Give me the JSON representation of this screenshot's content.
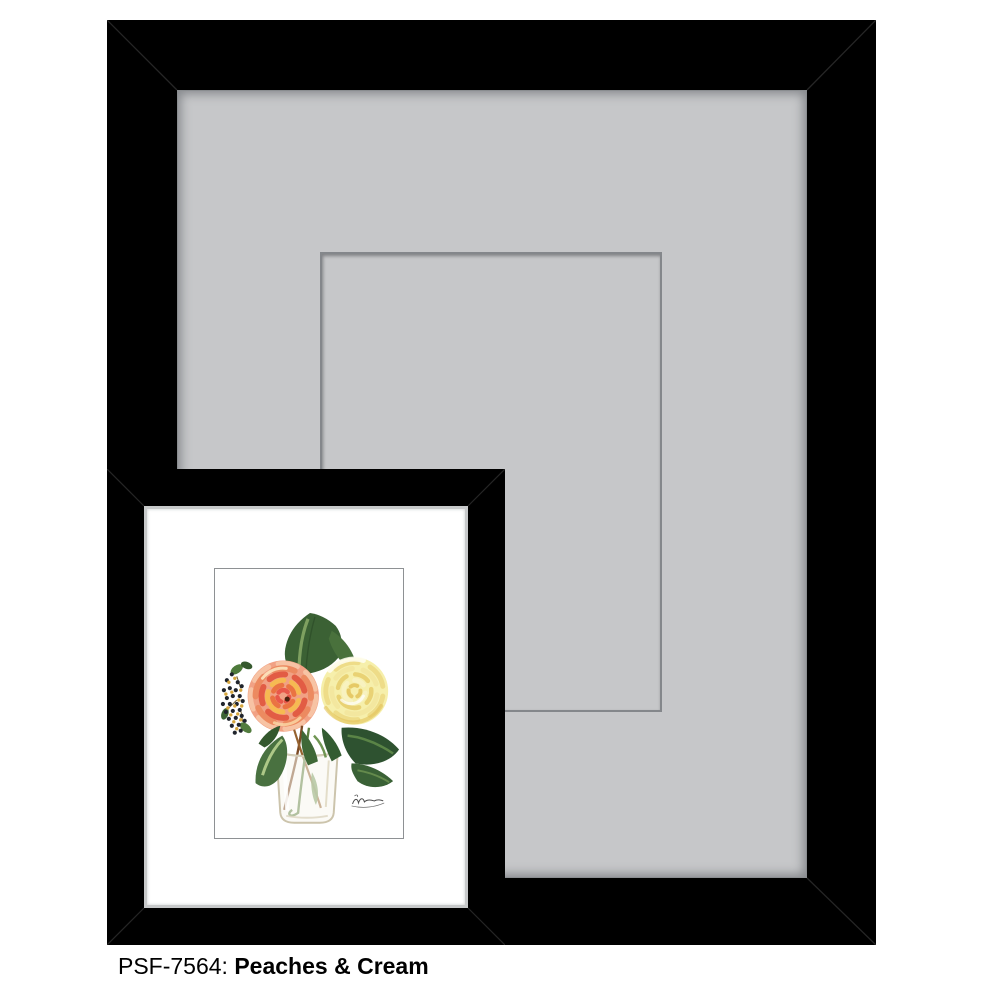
{
  "caption": {
    "sku": "PSF-7564:",
    "name": "Peaches & Cream"
  },
  "frame_preview": {
    "large_frame_color": "#000000",
    "large_mat_color": "#c6c7c9",
    "mat_opening_line_color": "#84878b",
    "small_frame_color": "#000000",
    "small_mat_color": "#ffffff",
    "small_mat_fillet_color": "#c7c9ca",
    "artwork_border_color": "#8e9194",
    "page_background": "#ffffff"
  },
  "artwork_palette": {
    "peach_rose_base": "#f1a184",
    "peach_rose_coral": "#e25c44",
    "peach_rose_orange": "#ec8a60",
    "peach_rose_gold": "#f6ba52",
    "peach_rose_cream": "#fce4bc",
    "rose_center_dark": "#4e2410",
    "yellow_rose_base": "#f6efab",
    "yellow_rose_deep": "#e9d274",
    "yellow_rose_shade": "#e3c158",
    "leaf_dark": "#2e5230",
    "leaf_mid": "#497140",
    "leaf_light": "#b8d18f",
    "berry_dark": "#20242c",
    "berry_gold": "#d6a63d",
    "stem_brown": "#7c4a24",
    "vase_outline": "#ccc4ac",
    "signature_ink": "#4a4a4a"
  }
}
